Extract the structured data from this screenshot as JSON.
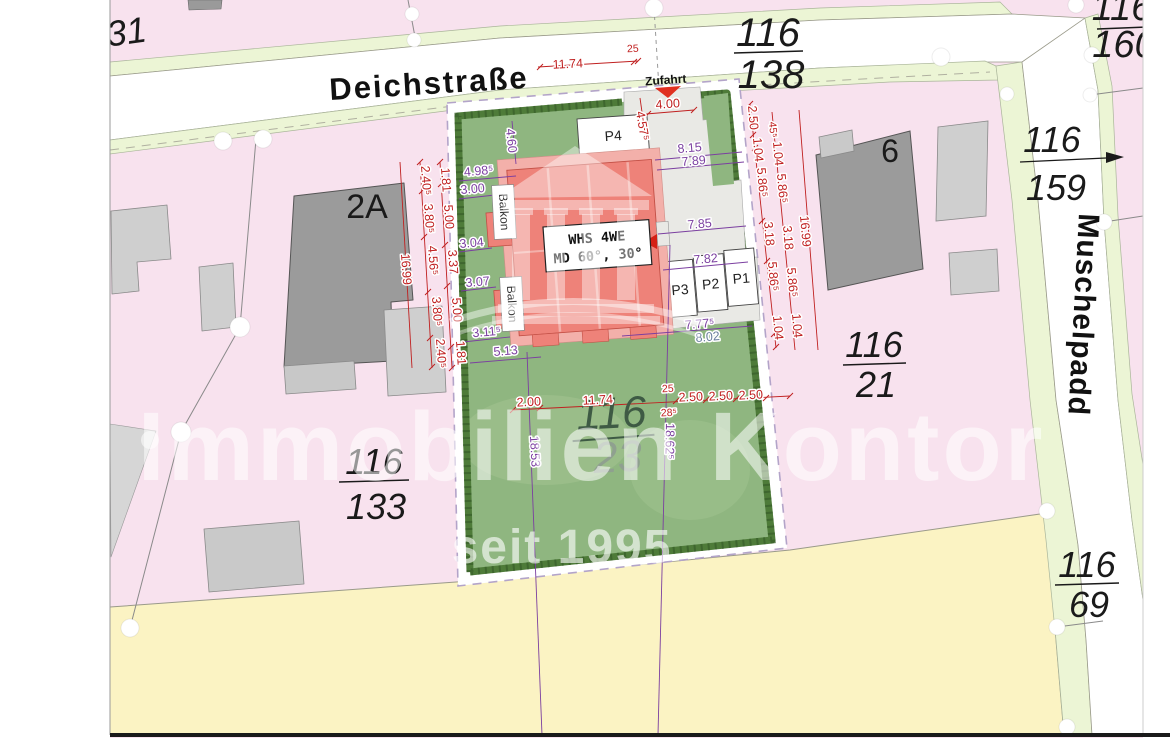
{
  "streets": {
    "main": "Deichstraße",
    "side": "Muschelpadd"
  },
  "parcels": {
    "road_north": {
      "num": "116",
      "den": "138"
    },
    "corner_ne": {
      "num": "116",
      "den": "160"
    },
    "road_east": {
      "num": "116",
      "den": "159"
    },
    "east": {
      "num": "116",
      "den": "21"
    },
    "site": {
      "num": "116",
      "den": "23"
    },
    "west": {
      "num": "116",
      "den": "133"
    },
    "south_east": {
      "num": "116",
      "den": "69"
    },
    "top_left": "31"
  },
  "buildings": {
    "west_label": "2A",
    "east_label": "6"
  },
  "site": {
    "access_label": "Zufahrt",
    "usage_line1": "WHS 4WE",
    "usage_md": "MD ",
    "usage_roof1": "60°",
    "usage_roof2": ", 30°",
    "balcony_label": "Balkon",
    "stall_p4": "P4",
    "stall_p3": "P3",
    "stall_p2": "P2",
    "stall_p1": "P1"
  },
  "dims": {
    "street": {
      "length": "11.74",
      "width": "25"
    },
    "entry": {
      "width": "4.00",
      "depth": "4.57⁵"
    },
    "west_outer": "16.99",
    "west_mid": [
      "2.40⁵",
      "3.80⁵",
      "4.56⁵",
      "3.80⁵",
      "2.40⁵"
    ],
    "west_inner": [
      "1.81",
      "5.00",
      "3.37",
      "5.00",
      "1.81"
    ],
    "east_outer": "16.99",
    "east_a": [
      "2.50",
      "1.04",
      "5.86⁵",
      "3.18",
      "5.86⁵",
      "1.04"
    ],
    "east_b": [
      "45⁵",
      "1.04",
      "5.86⁵",
      "3.18",
      "5.86⁵",
      "1.04"
    ],
    "south": [
      "2.00",
      "11.74",
      "25",
      "28⁵",
      "2.50",
      "2.50",
      "2.50"
    ],
    "west_purple": [
      "4.60",
      "4.98⁵",
      "3.00",
      "3.04",
      "3.07",
      "3.11⁵",
      "5.13"
    ],
    "east_purple": [
      "8.15",
      "7.89",
      "7.85",
      "7.82",
      "7.77⁵"
    ],
    "depth": [
      "18.53",
      "18.62⁵"
    ],
    "existing": "8.02"
  },
  "watermark": {
    "brand": "S Immobilien Kontor",
    "since": "seit 1995"
  },
  "colors": {
    "parcel_pink": "#f8e2ee",
    "verge_green": "#ecf5d5",
    "plot_green": "#8fb680",
    "hedge_green": "#4e7b39",
    "south_yellow": "#fbf3c3",
    "dim_red": "#c02020",
    "dim_purple": "#7b3fa0",
    "existing_blue": "#6b7f9e",
    "building_red": "#ee8279",
    "roof_pink": "#f3b0aa"
  }
}
